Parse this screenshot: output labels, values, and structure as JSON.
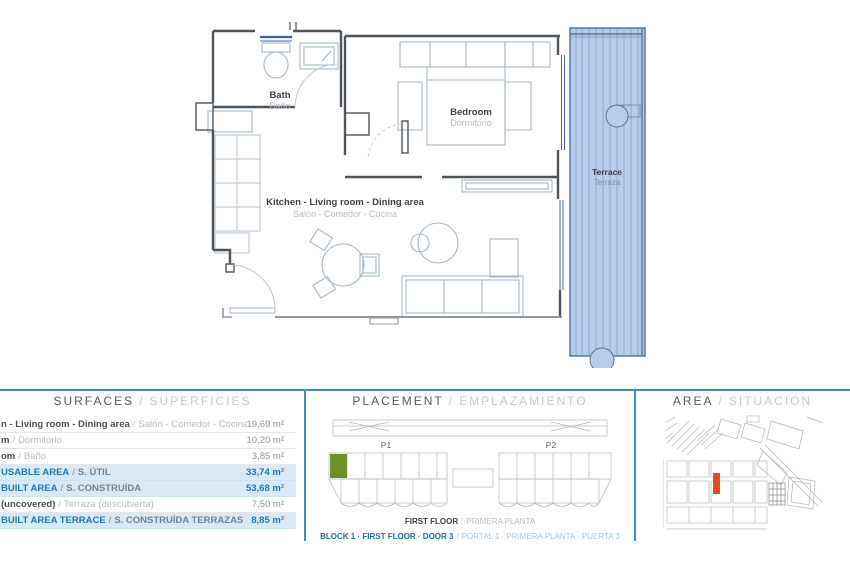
{
  "ui": {
    "slash": "/"
  },
  "floor_plan": {
    "rooms": {
      "bath": {
        "en": "Bath",
        "es": "Baño"
      },
      "bedroom": {
        "en": "Bedroom",
        "es": "Dormitorio"
      },
      "kitchen": {
        "en": "Kitchen - Living room - Dining area",
        "es": "Salón - Comedor - Cocina"
      },
      "terrace": {
        "en": "Terrace",
        "es": "Terraza"
      }
    },
    "colors": {
      "terrace_fill": "#b5cde9",
      "terrace_stripe": "#8fa9d0",
      "wall": "#4d545b"
    }
  },
  "surfaces": {
    "title": {
      "en": "SURFACES",
      "es": "SUPERFICIES"
    },
    "rows": [
      {
        "en": "n - Living room - Dining area",
        "es": "Salón - Comedor - Cocina",
        "value": "19,69 m²",
        "highlight": false
      },
      {
        "en": "m",
        "es": "Dormitorio",
        "value": "10,20 m²",
        "highlight": false
      },
      {
        "en": "om",
        "es": "Baño",
        "value": "3,85 m²",
        "highlight": false
      },
      {
        "en": "USABLE AREA",
        "es": "S. ÚTIL",
        "value": "33,74 m²",
        "highlight": true
      },
      {
        "en": "BUILT AREA",
        "es": "S. CONSTRUÍDA",
        "value": "53,68 m²",
        "highlight": true
      },
      {
        "en": "(uncovered)",
        "es": "Terraza (descubierta)",
        "value": "7,50 m²",
        "highlight": false
      },
      {
        "en": "BUILT AREA TERRACE",
        "es": "S. CONSTRUÍDA TERRAZAS",
        "value": "8,85 m²",
        "highlight": true
      }
    ]
  },
  "placement": {
    "title": {
      "en": "PLACEMENT",
      "es": "EMPLAZAMIENTO"
    },
    "labels": {
      "p1": "P1",
      "p2": "P2"
    },
    "floor": {
      "en": "FIRST FLOOR",
      "es": "PRIMERA PLANTA"
    },
    "unit": {
      "en": "BLOCK 1 · FIRST FLOOR · DOOR 3",
      "es": "PORTAL 1 · PRIMERA PLANTA · PUERTA 3"
    },
    "unit_color": "#6d8f2b"
  },
  "area": {
    "title": {
      "en": "AREA",
      "es": "SITUACIÓN"
    },
    "marker_color": "#e84c1e"
  }
}
